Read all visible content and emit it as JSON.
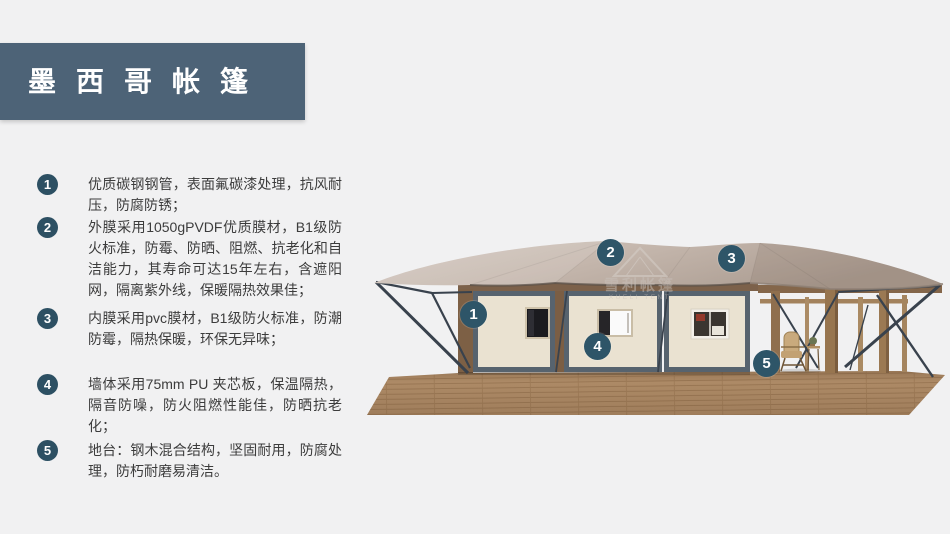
{
  "colors": {
    "background": "#f1f1f2",
    "banner": "#4d6377",
    "badge": "#2d5063",
    "callout": "#2e5568",
    "body_text": "#3c3c3c",
    "roof_tan": "#c2b4aa",
    "wall_cream": "#eae2d1",
    "frame_gray": "#57636e",
    "deck_wood": "#ad8a66"
  },
  "title": {
    "text": "墨西哥帐篷"
  },
  "features": [
    {
      "num": "1",
      "text": "优质碳钢钢管，表面氟碳漆处理，抗风耐压，防腐防锈；"
    },
    {
      "num": "2",
      "text": "外膜采用1050gPVDF优质膜材，B1级防火标准，防霉、防晒、阻燃、抗老化和自洁能力，其寿命可达15年左右，含遮阳网，隔离紫外线，保暖隔热效果佳；"
    },
    {
      "num": "3",
      "text": "内膜采用pvc膜材，B1级防火标准，防潮防霉，隔热保暖，环保无异味；"
    },
    {
      "num": "4",
      "text": "墙体采用75mm PU 夹芯板，保温隔热，隔音防噪，防火阻燃性能佳，防晒抗老化；"
    },
    {
      "num": "5",
      "text": "地台：钢木混合结构，坚固耐用，防腐处理，防朽耐磨易清洁。"
    }
  ],
  "diagram": {
    "watermark": {
      "brand": "雪利帐篷",
      "brand_en": "XUELI TENT"
    },
    "callouts": [
      {
        "num": "1"
      },
      {
        "num": "2"
      },
      {
        "num": "3"
      },
      {
        "num": "4"
      },
      {
        "num": "5"
      }
    ]
  }
}
